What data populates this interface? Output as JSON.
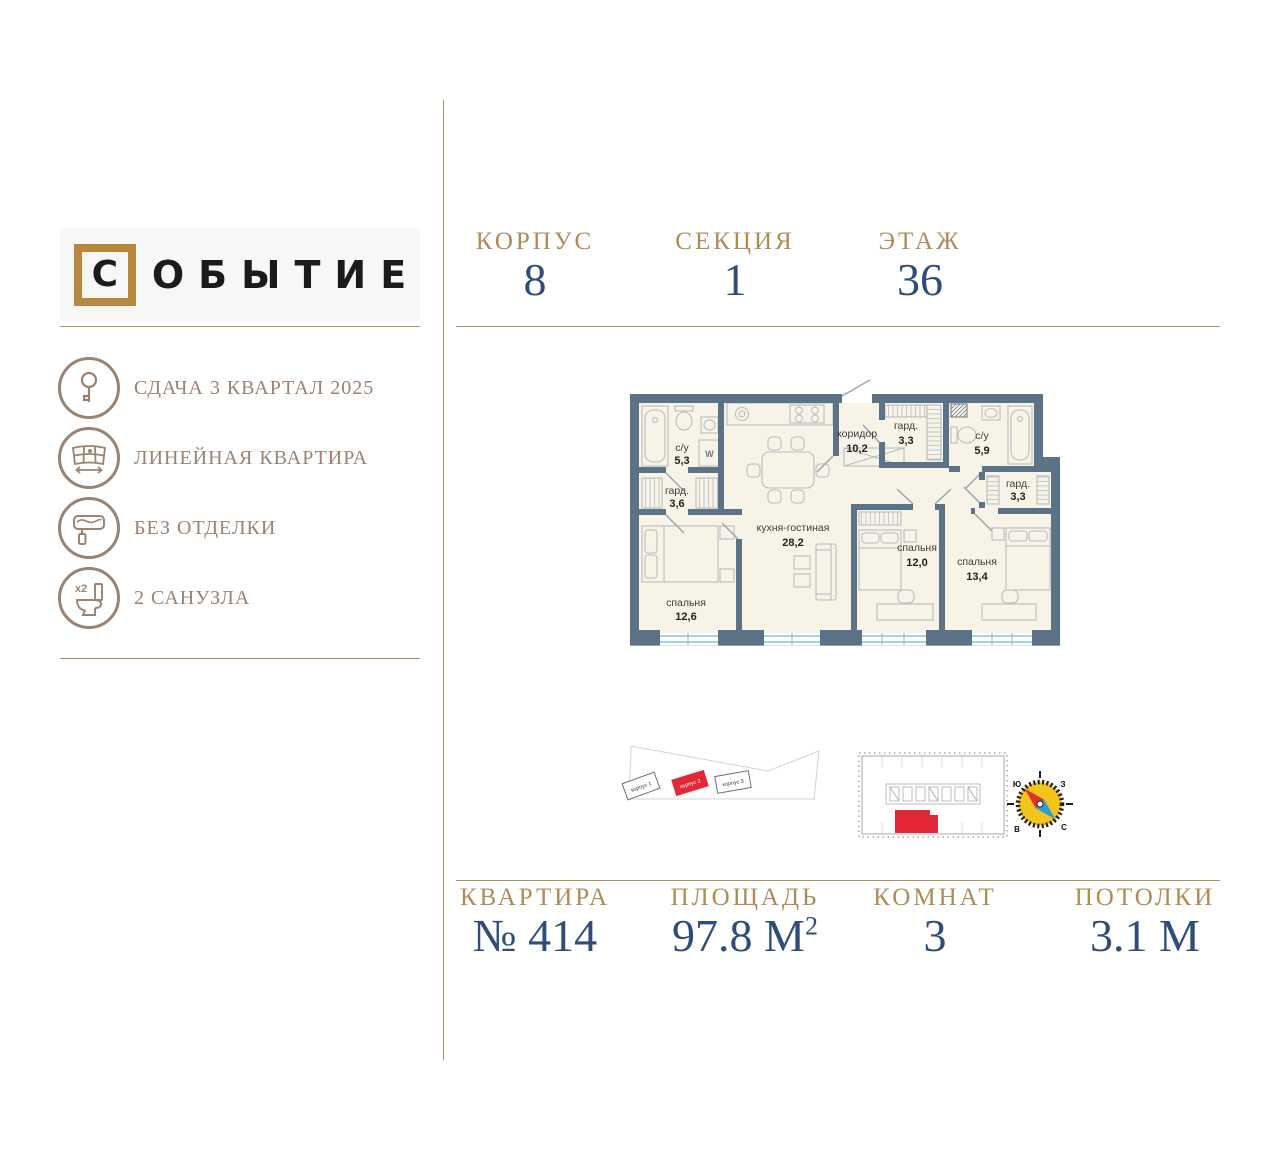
{
  "brand": {
    "first_letter": "С",
    "rest_letters": "ОБЫТИЕ",
    "name": "СОБЫТИЕ"
  },
  "sidebar": {
    "features": [
      {
        "icon": "key-icon",
        "label": "СДАЧА 3 КВАРТАЛ 2025"
      },
      {
        "icon": "panorama-window-icon",
        "label": "ЛИНЕЙНАЯ КВАРТИРА"
      },
      {
        "icon": "paint-roller-icon",
        "label": "БЕЗ ОТДЕЛКИ"
      },
      {
        "icon": "toilet-icon",
        "label": "2 САНУЗЛА",
        "badge": "x2"
      }
    ]
  },
  "header": {
    "stats": [
      {
        "label": "КОРПУС",
        "value": "8"
      },
      {
        "label": "СЕКЦИЯ",
        "value": "1"
      },
      {
        "label": "ЭТАЖ",
        "value": "36"
      }
    ]
  },
  "footer": {
    "stats": [
      {
        "label": "КВАРТИРА",
        "value": "№ 414"
      },
      {
        "label": "ПЛОЩАДЬ",
        "value": "97.8 М",
        "value_sup": "2"
      },
      {
        "label": "КОМНАТ",
        "value": "3"
      },
      {
        "label": "ПОТОЛКИ",
        "value": "3.1 М"
      }
    ]
  },
  "floor_plan": {
    "washer_label": "W",
    "rooms": [
      {
        "name": "с/у",
        "area": "5,3"
      },
      {
        "name": "гард.",
        "area": "3,6"
      },
      {
        "name": "спальня",
        "area": "12,6"
      },
      {
        "name": "кухня-гостиная",
        "area": "28,2"
      },
      {
        "name": "коридор",
        "area": "10,2"
      },
      {
        "name": "гард.",
        "area": "3,3"
      },
      {
        "name": "с/у",
        "area": "5,9"
      },
      {
        "name": "гард.",
        "area": "3,3"
      },
      {
        "name": "спальня",
        "area": "12,0"
      },
      {
        "name": "спальня",
        "area": "13,4"
      }
    ]
  },
  "site_plan": {
    "buildings": [
      {
        "label": "корпус 1",
        "highlighted": false
      },
      {
        "label": "корпус 2",
        "highlighted": true
      },
      {
        "label": "корпус 3",
        "highlighted": false
      }
    ]
  },
  "compass": {
    "south": "Ю",
    "west": "З",
    "east": "В",
    "north": "С"
  },
  "colors": {
    "gold": "#a98e5e",
    "bronze": "#9b8271",
    "navy": "#2e4d78",
    "wall": "#5c7387",
    "floor": "#f7f3e6",
    "window_blue": "#a9d2e6",
    "highlight_red": "#e32736",
    "logo_gold": "#b8893c"
  }
}
